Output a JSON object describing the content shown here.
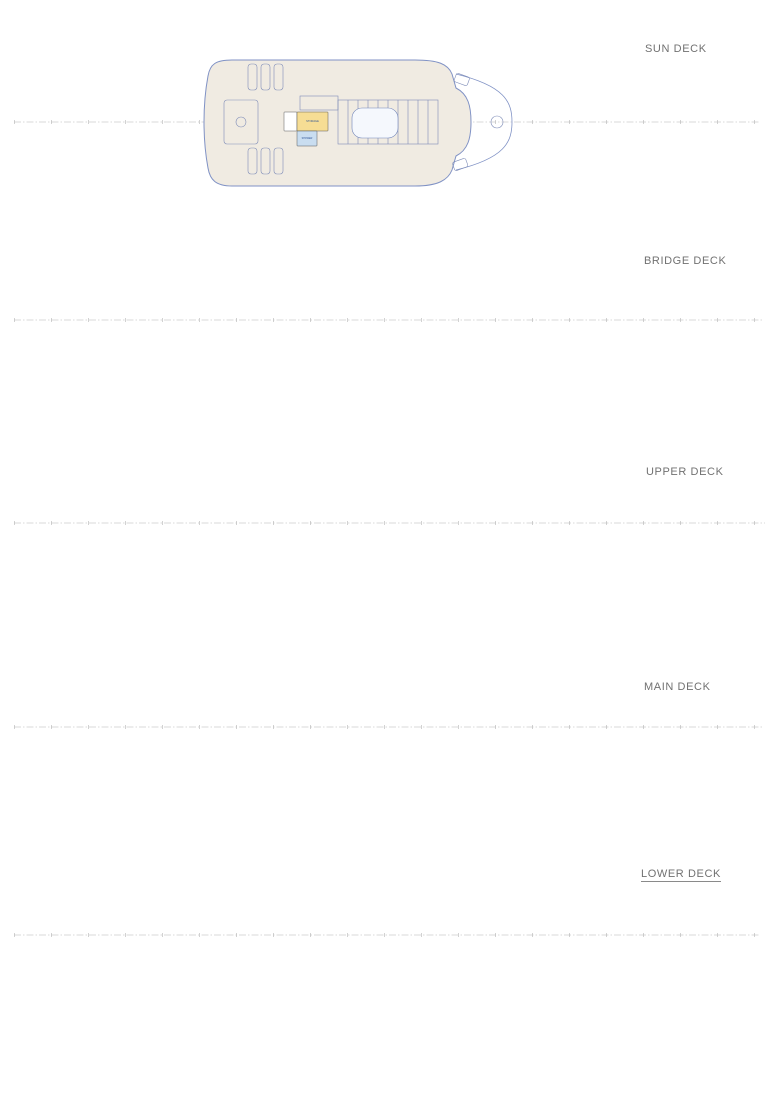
{
  "colors": {
    "hull": "#8092c5",
    "deck_fill": "#f0ebe2",
    "wall": "#4a4a4a",
    "label": "#2f5496",
    "furniture": "#7f8db8",
    "fills": {
      "blue": "#c9ddf0",
      "yellow": "#f6dd94",
      "pink": "#e79ae0",
      "green": "#c9ef91",
      "bgreen": "#b7ee7c",
      "white": "#ffffff"
    }
  },
  "decks": [
    {
      "label": "SUN DECK",
      "rooms": [
        {
          "l": "",
          "x": 284,
          "y": 112,
          "w": 13,
          "h": 19,
          "f": "white"
        },
        {
          "l": "STORAGE",
          "x": 297,
          "y": 112,
          "w": 31,
          "h": 19,
          "f": "yellow",
          "fs": 2.6
        },
        {
          "l": "SHOWER",
          "x": 297,
          "y": 131,
          "w": 20,
          "h": 15,
          "f": "blue",
          "fs": 2.4
        }
      ]
    },
    {
      "label": "BRIDGE DECK",
      "rooms": [
        {
          "l": "OWNER'S LOUNGE",
          "x": 238,
          "y": 263,
          "w": 124,
          "h": 114,
          "f": "blue",
          "fs": 3.4
        },
        {
          "l": "WC",
          "x": 315,
          "y": 271,
          "w": 14,
          "h": 17,
          "f": "blue",
          "fs": 2.4
        },
        {
          "l": "",
          "x": 330,
          "y": 271,
          "w": 15,
          "h": 19,
          "f": "white"
        },
        {
          "l": "STORAGE",
          "x": 345,
          "y": 276,
          "w": 13,
          "h": 25,
          "f": "green",
          "fs": 2.2,
          "v": true
        },
        {
          "l": "FOYER",
          "x": 330,
          "y": 301,
          "w": 30,
          "h": 51,
          "f": "pink",
          "fs": 3
        },
        {
          "l": "BAR",
          "x": 298,
          "y": 324,
          "w": 25,
          "h": 43,
          "f": "yellow",
          "fs": 2.8
        },
        {
          "l": "OB MASTER BEDROOM",
          "x": 362,
          "y": 271,
          "w": 51,
          "h": 47,
          "f": "blue",
          "fs": 2.4
        },
        {
          "l": "BATHROOM OB",
          "x": 414,
          "y": 271,
          "w": 42,
          "h": 47,
          "f": "blue",
          "fs": 2.4
        },
        {
          "l": "OWNERS HALLWAY",
          "x": 362,
          "y": 319,
          "w": 94,
          "h": 8,
          "f": "blue",
          "fs": 2.2
        },
        {
          "l": "OB SALON",
          "x": 362,
          "y": 328,
          "w": 33,
          "h": 41,
          "f": "blue",
          "fs": 2.4
        },
        {
          "l": "OB OFFICE",
          "x": 396,
          "y": 328,
          "w": 34,
          "h": 41,
          "f": "blue",
          "fs": 2.4
        },
        {
          "l": "WC OB",
          "x": 431,
          "y": 328,
          "w": 25,
          "h": 41,
          "f": "blue",
          "fs": 2.4
        },
        {
          "l": "CAPTAIN ROOM",
          "x": 457,
          "y": 271,
          "w": 31,
          "h": 47,
          "f": "yellow",
          "fs": 2.2
        },
        {
          "l": "1st ENG. ROOM",
          "x": 457,
          "y": 322,
          "w": 31,
          "h": 47,
          "f": "yellow",
          "fs": 2.2
        },
        {
          "l": "WHEELHOUSE",
          "x": 489,
          "y": 271,
          "w": 32,
          "h": 98,
          "f": "yellow",
          "fs": 2.4,
          "r": 12
        }
      ]
    },
    {
      "label": "UPPER DECK",
      "rooms": [
        {
          "l": "SALON",
          "x": 215,
          "y": 464,
          "w": 73,
          "h": 121,
          "f": "blue",
          "fs": 4
        },
        {
          "l": "STORAGE",
          "x": 273,
          "y": 490,
          "w": 15,
          "h": 18,
          "f": "yellow",
          "fs": 1.8
        },
        {
          "l": "GUEST BATHROOM",
          "x": 289,
          "y": 490,
          "w": 16,
          "h": 19,
          "f": "blue",
          "fs": 1.6
        },
        {
          "l": "STORAGE",
          "x": 306,
          "y": 490,
          "w": 11,
          "h": 18,
          "f": "yellow",
          "fs": 1.6,
          "v": true
        },
        {
          "l": "",
          "x": 330,
          "y": 490,
          "w": 13,
          "h": 18,
          "f": "yellow"
        },
        {
          "l": "PANTRY",
          "x": 277,
          "y": 526,
          "w": 22,
          "h": 22,
          "f": "yellow",
          "fs": 2.4
        },
        {
          "l": "STORAGE",
          "x": 305,
          "y": 527,
          "w": 18,
          "h": 11,
          "f": "yellow",
          "fs": 1.8
        },
        {
          "l": "TECH SPACE",
          "x": 305,
          "y": 540,
          "w": 14,
          "h": 16,
          "f": "green",
          "fs": 1.6
        },
        {
          "l": "HALLWAY",
          "x": 300,
          "y": 511,
          "w": 28,
          "h": 12,
          "f": "pink",
          "fs": 2.2
        },
        {
          "l": "FOYER",
          "x": 328,
          "y": 505,
          "w": 30,
          "h": 48,
          "f": "pink",
          "fs": 3
        },
        {
          "l": "HALLWAY",
          "x": 358,
          "y": 517,
          "w": 174,
          "h": 12,
          "f": "pink",
          "fs": 2.8
        },
        {
          "l": "ROOM #1",
          "x": 362,
          "y": 464,
          "w": 55,
          "h": 52,
          "f": "blue",
          "fs": 3
        },
        {
          "l": "ROOM #3",
          "x": 418,
          "y": 464,
          "w": 55,
          "h": 52,
          "f": "blue",
          "fs": 3
        },
        {
          "l": "ROOM #5",
          "x": 474,
          "y": 464,
          "w": 54,
          "h": 52,
          "f": "blue",
          "fs": 3
        },
        {
          "l": "HOSPITAL",
          "x": 530,
          "y": 467,
          "w": 21,
          "h": 26,
          "f": "blue",
          "fs": 2
        },
        {
          "l": "WC",
          "x": 528,
          "y": 496,
          "w": 13,
          "h": 15,
          "f": "blue",
          "fs": 2
        },
        {
          "l": "",
          "x": 556,
          "y": 483,
          "w": 17,
          "h": 32,
          "f": "yellow"
        },
        {
          "l": "ROOM #2",
          "x": 362,
          "y": 530,
          "w": 55,
          "h": 53,
          "f": "blue",
          "fs": 3
        },
        {
          "l": "ROOM #4",
          "x": 418,
          "y": 530,
          "w": 55,
          "h": 53,
          "f": "blue",
          "fs": 3
        },
        {
          "l": "ROOM #6",
          "x": 474,
          "y": 530,
          "w": 54,
          "h": 53,
          "f": "blue",
          "fs": 3
        },
        {
          "l": "FITNESS ROOM",
          "x": 529,
          "y": 531,
          "w": 50,
          "h": 44,
          "f": "blue",
          "fs": 2.6
        }
      ]
    },
    {
      "label": "MAIN DECK",
      "rooms": [
        {
          "l": "MAIN DINING AREA",
          "x": 172,
          "y": 666,
          "w": 90,
          "h": 121,
          "f": "blue",
          "fs": 3.2
        },
        {
          "l": "P.A. OFFICE",
          "x": 282,
          "y": 670,
          "w": 23,
          "h": 15,
          "f": "white",
          "fs": 1.8
        },
        {
          "l": "WC",
          "x": 307,
          "y": 668,
          "w": 16,
          "h": 17,
          "f": "blue",
          "fs": 2.4
        },
        {
          "l": "HALLWAY",
          "x": 277,
          "y": 686,
          "w": 51,
          "h": 13,
          "f": "pink",
          "fs": 2.6
        },
        {
          "l": "GALLEY",
          "x": 263,
          "y": 701,
          "w": 54,
          "h": 70,
          "f": "yellow",
          "fs": 3
        },
        {
          "l": "BAKERY",
          "x": 264,
          "y": 702,
          "w": 24,
          "h": 22,
          "f": "yellow",
          "fs": 2
        },
        {
          "l": "OFFICE",
          "x": 366,
          "y": 686,
          "w": 16,
          "h": 12,
          "f": "yellow",
          "fs": 1.8
        },
        {
          "l": "FOYER",
          "x": 328,
          "y": 686,
          "w": 57,
          "h": 82,
          "f": "pink",
          "fs": 3.4
        },
        {
          "l": "TECH SPACE",
          "x": 287,
          "y": 751,
          "w": 18,
          "h": 12,
          "f": "green",
          "fs": 1.6
        },
        {
          "l": "STORE",
          "x": 289,
          "y": 771,
          "w": 17,
          "h": 13,
          "f": "yellow",
          "fs": 1.8
        },
        {
          "l": "STORE",
          "x": 310,
          "y": 771,
          "w": 16,
          "h": 13,
          "f": "yellow",
          "fs": 1.8
        },
        {
          "l": "TECH SPACE",
          "x": 330,
          "y": 769,
          "w": 23,
          "h": 24,
          "f": "green",
          "fs": 1.8
        },
        {
          "l": "TECH SPACE",
          "x": 384,
          "y": 756,
          "w": 20,
          "h": 15,
          "f": "green",
          "fs": 1.6
        },
        {
          "l": "TECH SPACE",
          "x": 383,
          "y": 773,
          "w": 27,
          "h": 21,
          "f": "green",
          "fs": 1.8
        },
        {
          "l": "CINEMA ROOM",
          "x": 391,
          "y": 665,
          "w": 41,
          "h": 53,
          "f": "blue",
          "fs": 2.4
        },
        {
          "l": "ROOM #7",
          "x": 433,
          "y": 670,
          "w": 36,
          "h": 48,
          "f": "blue",
          "fs": 2.6
        },
        {
          "l": "ROOM #9",
          "x": 470,
          "y": 670,
          "w": 34,
          "h": 48,
          "f": "blue",
          "fs": 2.6
        },
        {
          "l": "ROOM #11",
          "x": 505,
          "y": 670,
          "w": 31,
          "h": 48,
          "f": "blue",
          "fs": 2.6
        },
        {
          "l": "",
          "x": 541,
          "y": 680,
          "w": 31,
          "h": 42,
          "f": "yellow"
        },
        {
          "l": "HALLWAY",
          "x": 385,
          "y": 720,
          "w": 196,
          "h": 13,
          "f": "pink",
          "fs": 2.8
        },
        {
          "l": "ROOM #8",
          "x": 410,
          "y": 735,
          "w": 44,
          "h": 51,
          "f": "blue",
          "fs": 2.6
        },
        {
          "l": "ROOM #10",
          "x": 455,
          "y": 735,
          "w": 43,
          "h": 51,
          "f": "blue",
          "fs": 2.6
        },
        {
          "l": "ROOM #12",
          "x": 499,
          "y": 735,
          "w": 40,
          "h": 51,
          "f": "blue",
          "fs": 2.6
        },
        {
          "l": "ROOM #13",
          "x": 572,
          "y": 693,
          "w": 46,
          "h": 28,
          "f": "blue",
          "fs": 2.6
        },
        {
          "l": "ROOM #14",
          "x": 572,
          "y": 733,
          "w": 46,
          "h": 28,
          "f": "blue",
          "fs": 2.6
        },
        {
          "l": "",
          "x": 620,
          "y": 699,
          "w": 22,
          "h": 21,
          "f": "blue"
        },
        {
          "l": "",
          "x": 620,
          "y": 734,
          "w": 22,
          "h": 21,
          "f": "blue"
        }
      ]
    },
    {
      "label": "LOWER DECK",
      "rooms": [
        {
          "l": "",
          "x": 116,
          "y": 871,
          "w": 72,
          "h": 62,
          "f": "green",
          "r": 6
        },
        {
          "l": "BEACH AREA",
          "x": 116,
          "y": 934,
          "w": 72,
          "h": 44,
          "f": "blue",
          "tc": "#ffffff",
          "fs": 3,
          "r": 6
        },
        {
          "l": "",
          "x": 189,
          "y": 874,
          "w": 146,
          "h": 112,
          "f": "green"
        },
        {
          "l": "",
          "pts": "335,883 455,885 550,909 557,935 550,961 455,974 335,976",
          "f": "yellow"
        },
        {
          "l": "",
          "pts": "560,909 663,935 560,961",
          "f": "bgreen"
        },
        {
          "l": "LAUNDRY",
          "x": 338,
          "y": 897,
          "w": 30,
          "h": 28,
          "f": "yellow",
          "fs": 2.4
        },
        {
          "l": "CREW MESS",
          "x": 338,
          "y": 932,
          "w": 36,
          "h": 41,
          "f": "yellow",
          "fs": 2.4
        },
        {
          "l": "CABIN",
          "x": 385,
          "y": 902,
          "f": "none",
          "fs": 2.2
        },
        {
          "l": "CABIN",
          "x": 420,
          "y": 900,
          "f": "none",
          "fs": 2.2
        },
        {
          "l": "CABIN",
          "x": 455,
          "y": 899,
          "f": "none",
          "fs": 2.2
        },
        {
          "l": "CABIN",
          "x": 488,
          "y": 903,
          "f": "none",
          "fs": 2.2
        },
        {
          "l": "CABIN",
          "x": 518,
          "y": 907,
          "f": "none",
          "fs": 2.2
        },
        {
          "l": "CABIN",
          "x": 385,
          "y": 958,
          "f": "none",
          "fs": 2.2
        },
        {
          "l": "CABIN",
          "x": 420,
          "y": 960,
          "f": "none",
          "fs": 2.2
        },
        {
          "l": "CABIN",
          "x": 455,
          "y": 961,
          "f": "none",
          "fs": 2.2
        },
        {
          "l": "CABIN",
          "x": 488,
          "y": 957,
          "f": "none",
          "fs": 2.2
        },
        {
          "l": "CABIN",
          "x": 518,
          "y": 953,
          "f": "none",
          "fs": 2.2
        }
      ]
    }
  ]
}
